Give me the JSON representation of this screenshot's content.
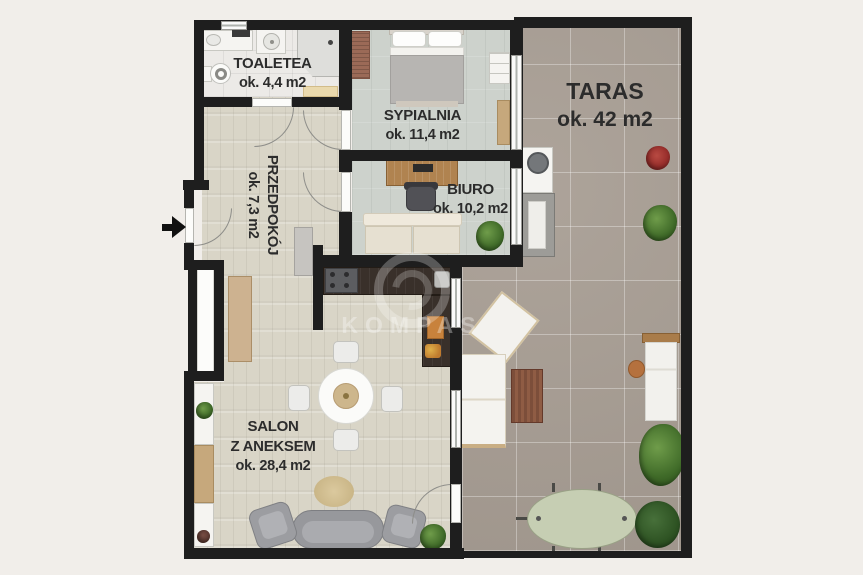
{
  "plan": {
    "rooms": {
      "toaleta": {
        "name": "TOALETEA",
        "area": "ok. 4,4 m2"
      },
      "sypialnia": {
        "name": "SYPIALNIA",
        "area": "ok. 11,4 m2"
      },
      "przedpokoj": {
        "name": "PRZEDPOKÓJ",
        "area": "ok. 7,3 m2"
      },
      "biuro": {
        "name": "BIURO",
        "area": "ok. 10,2 m2"
      },
      "salon": {
        "name_line1": "SALON",
        "name_line2": "Z ANEKSEM",
        "area": "ok. 28,4 m2"
      },
      "taras": {
        "name": "TARAS",
        "area": "ok. 42 m2"
      }
    },
    "watermark": "KOMPAS",
    "colors": {
      "wall": "#1e1e1e",
      "background": "#f1eeea",
      "terrace_floor": "#a89e94",
      "hall_salon_floor": "#d9d5c7",
      "bedroom_office_floor": "#cdd2cc",
      "bathroom_floor": "#eceae7",
      "label_text": "#2c2c2c"
    }
  }
}
